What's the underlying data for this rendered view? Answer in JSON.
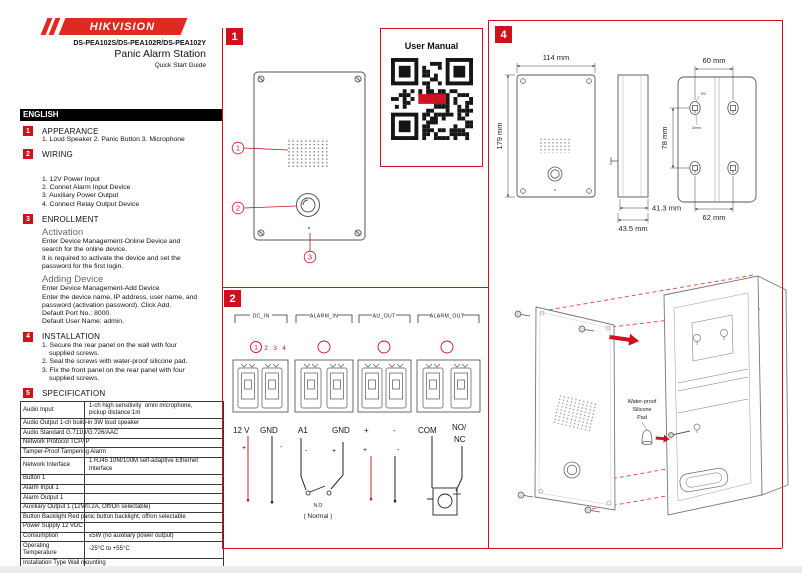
{
  "header": {
    "brand": "HIKVISION",
    "models": "DS-PEA102S/DS-PEA102R/DS-PEA102Y",
    "product": "Panic Alarm Station",
    "subtitle": "Quick Start Guide",
    "language": "ENGLISH"
  },
  "left": {
    "s1": {
      "num": "1",
      "title": "APPEARANCE",
      "line": "1. Loud Speaker   2. Panic Button   3. Microphone"
    },
    "s2": {
      "num": "2",
      "title": "WIRING",
      "items": [
        "1. 12V Power Input",
        "2. Connet Alarm Input Device",
        "3. Auxiliary Power Output",
        "4. Connect Relay Output Device"
      ]
    },
    "s3": {
      "num": "3",
      "title": "ENROLLMENT",
      "activation_title": "Activation",
      "activation_text": "Enter Device Management-Online Device and\nsearch for the online device.\nIt is required to activate the device and set the\npassword for the first login.",
      "adding_title": "Adding Device",
      "adding_text": "Enter Device Management-Add Device\nEnter the device name, IP address, user name, and\npassword (activation password). Click Add.\nDefault Port No.: 8000.\nDefault User Name: admin."
    },
    "s4": {
      "num": "4",
      "title": "INSTALLATION",
      "items": [
        "1. Secure the rear panel on the wall with four supplied screws.",
        "2. Seal the screws with water-proof silicone pad.",
        "3. Fix the front panel on the rear panel with four supplied screws."
      ]
    },
    "s5": {
      "num": "5",
      "title": "SPECIFICATION"
    },
    "spec_rows": [
      {
        "label": "Audio Input",
        "value": "1-ch high sensitivity  omni microphone,\npickup distance:1m"
      },
      {
        "label": "Audio Output 1-ch build-in 3W loud speaker",
        "value": ""
      },
      {
        "label": "Audio Standard G.711U/G.726/AAC",
        "value": ""
      },
      {
        "label": "Network Protocol TCP/IP",
        "value": ""
      },
      {
        "label": "Tamper-Proof Tampering Alarm",
        "value": ""
      },
      {
        "label": "Network Interface",
        "value": "1 RJ45 10M/100M self-adaptive Ethernet\nInterface"
      },
      {
        "label": "Button 1",
        "value": ""
      },
      {
        "label": "Alarm Input 1",
        "value": ""
      },
      {
        "label": "Alarm Output 1",
        "value": ""
      },
      {
        "label": "Auxiliary Output 1 (12V/0.2A, Off/On selectable)",
        "value": ""
      },
      {
        "label": "Button Backlight Red panic button backlight, off/on selectable",
        "value": ""
      },
      {
        "label": "Power Supply 12 VDC",
        "value": ""
      },
      {
        "label": "Consumption",
        "value": "≤5W (no auxiliary power output)"
      },
      {
        "label": "Operating\nTemperature",
        "value": "-25°C to +55°C"
      },
      {
        "label": "Installation Type Wall mounting",
        "value": ""
      },
      {
        "label": "Operating Humidity",
        "value": "10% to 90%"
      },
      {
        "label": "Protection Level IP54",
        "value": ""
      },
      {
        "label": "Network Encryption",
        "value": "User login lock and password complexity hint"
      }
    ]
  },
  "panel1": {
    "num": "1",
    "user_manual": "User Manual",
    "callout1": "1",
    "callout2": "2",
    "callout3": "3"
  },
  "panel2": {
    "num": "2",
    "g1": "DC_IN",
    "g2": "ALARM_IN",
    "g3": "AU_OUT",
    "g4": "ALARM_OUT",
    "pin1": "1",
    "pin2": "2",
    "pin3": "3",
    "pin4": "4",
    "v12": "12 V",
    "gnd": "GND",
    "a1": "A1",
    "plus": "+",
    "minus": "-",
    "com": "COM",
    "no": "NO/",
    "nc": "NC",
    "switch_label": "N.O",
    "switch_sub": "( Normal )"
  },
  "panel4": {
    "num": "4",
    "dim_width": "114 mm",
    "dim_height": "179 mm",
    "dim_hole_top": "60 mm",
    "dim_hole_v": "78 mm",
    "dim_depth_inner": "41.3 mm",
    "dim_depth_outer": "43.5 mm",
    "dim_hole_bottom": "62 mm",
    "note_r2": "R2",
    "note_2mm": "2mm",
    "pad_l1": "Water-proof",
    "pad_l2": "Silicone",
    "pad_l3": "Pad"
  }
}
